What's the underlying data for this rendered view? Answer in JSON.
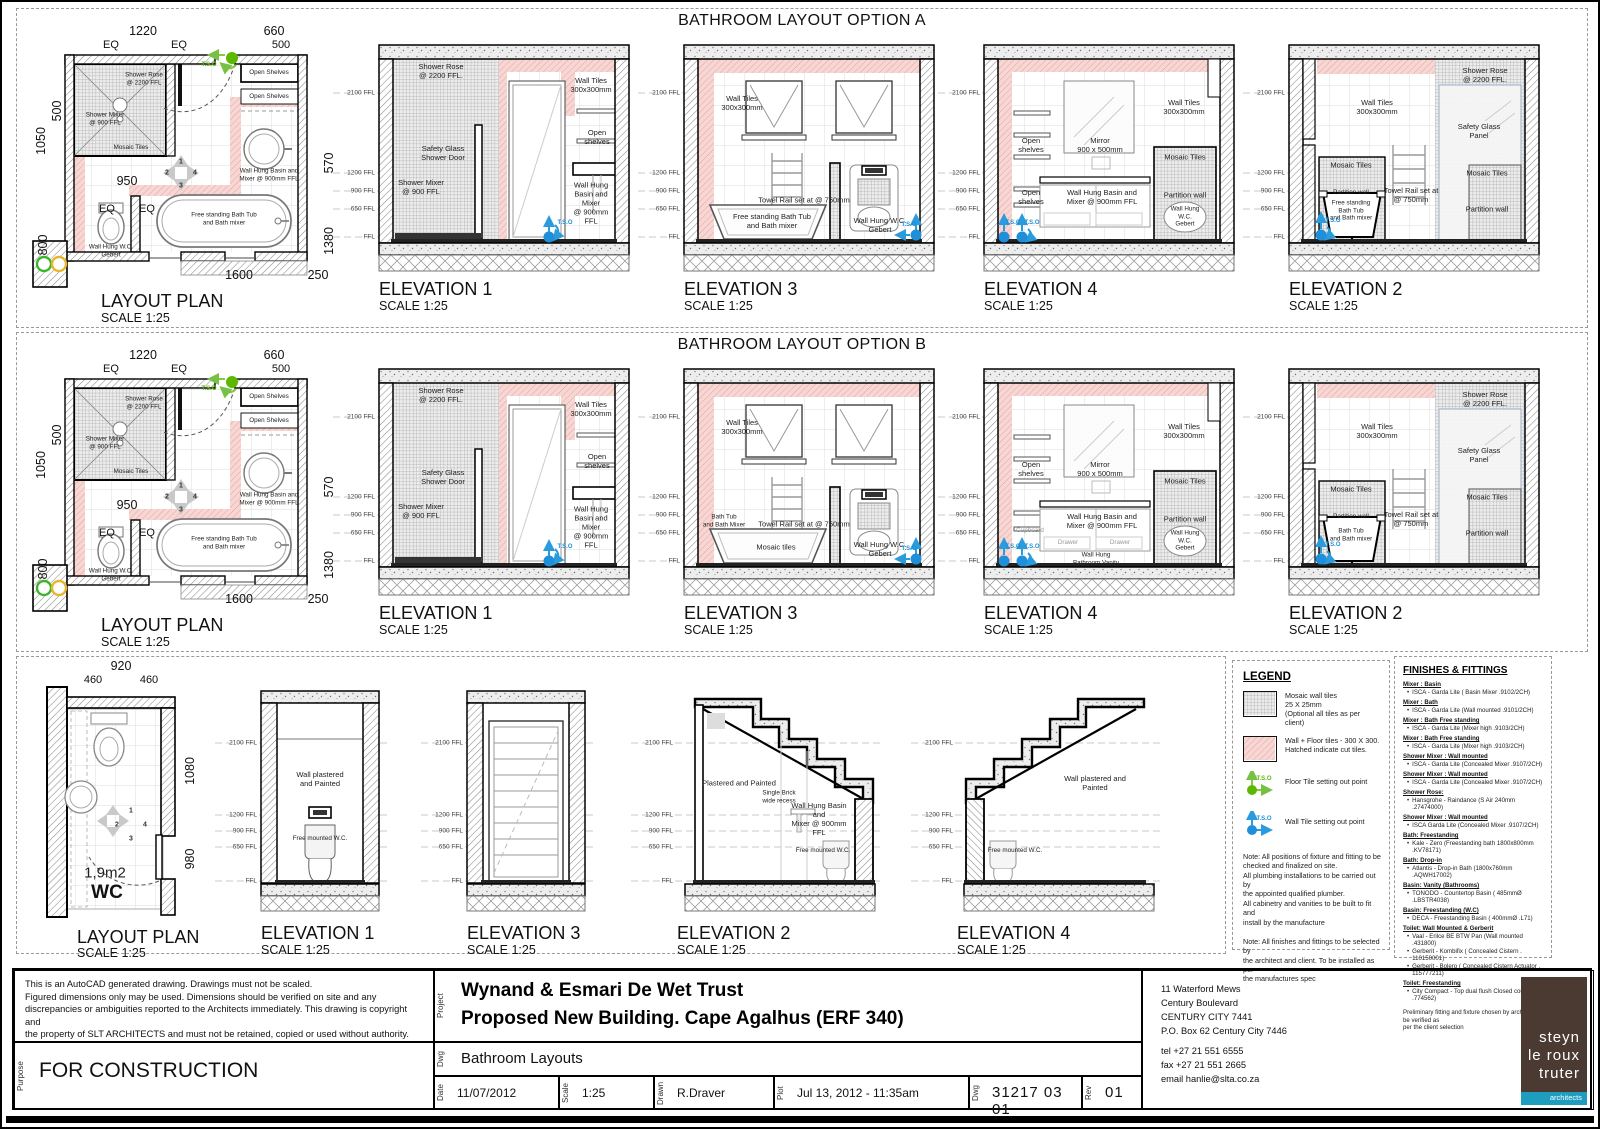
{
  "optionA": {
    "title": "BATHROOM LAYOUT OPTION A",
    "levels": [
      "2100 FFL",
      "1200 FFL",
      "900 FFL",
      "650 FFL",
      "FFL"
    ],
    "plan": {
      "caption": "LAYOUT PLAN",
      "scale": "SCALE 1:25",
      "dim_top": "1220",
      "dim_eq1": "EQ",
      "dim_eq2": "EQ",
      "dim_660": "660",
      "dim_500t": "500",
      "dim_1050": "1050",
      "dim_500l": "500",
      "dim_950": "950",
      "dim_eq3": "EQ",
      "dim_eq4": "EQ",
      "dim_800": "800",
      "dim_570": "570",
      "dim_1380": "1380",
      "dim_1600": "1600",
      "dim_250": "250",
      "lbl_shower_rose": "Shower Rose\n@ 2200 FFL",
      "lbl_shower_mixer": "Shower Mixer\n@ 900 FFL",
      "lbl_mosaic": "Mosaic Tiles",
      "lbl_shelves1": "Open Shelves",
      "lbl_shelves2": "Open Shelves",
      "lbl_basin": "Wall Hung Basin and\nMixer @ 900mm FFL",
      "lbl_bath": "Free standing Bath Tub\nand Bath mixer",
      "lbl_wc": "Wall Hung W.C.\nGebert",
      "tso": "T.S.O",
      "compass": [
        "1",
        "2",
        "3",
        "4"
      ]
    },
    "elev1": {
      "caption": "ELEVATION 1",
      "scale": "SCALE 1:25",
      "rose": "Shower Rose\n@ 2200 FFL.",
      "tiles": "Wall Tiles\n300x300mm",
      "shelves": "Open\nshelves",
      "door": "Safety Glass\nShower Door",
      "mixer": "Shower Mixer\n@ 900 FFL",
      "basin": "Wall Hung\nBasin and Mixer\n@ 900mm FFL",
      "tso": "T.S.O"
    },
    "elev3": {
      "caption": "ELEVATION 3",
      "scale": "SCALE 1:25",
      "tiles": "Wall Tiles\n300x300mm",
      "towel": "Towel Rail set at @ 750mm",
      "bath": "Free standing Bath Tub\nand Bath mixer",
      "wc": "Wall Hung W.C.\nGebert",
      "tso": "T.S.O"
    },
    "elev4": {
      "caption": "ELEVATION 4",
      "scale": "SCALE 1:25",
      "tiles": "Wall Tiles\n300x300mm",
      "shelves_top": "Open\nshelves",
      "mirror": "Mirror\n900 x 500mm",
      "mosaic": "Mosaic Tiles",
      "shelves_bot": "Open\nshelves",
      "basin": "Wall Hung Basin and\nMixer @ 900mm FFL",
      "partition": "Partition wall",
      "wc": "Wall Hung\nW.C.\nGebert",
      "tso1": "T.S.O",
      "tso2": "T.S.O"
    },
    "elev2": {
      "caption": "ELEVATION 2",
      "scale": "SCALE 1:25",
      "rose": "Shower Rose\n@ 2200 FFL.",
      "tiles": "Wall Tiles\n300x300mm",
      "glass": "Safety Glass\nPanel",
      "mosaic_l": "Mosaic Tiles",
      "mosaic_r": "Mosaic Tiles",
      "towel": "Towel Rail set at\n@ 750mm",
      "partition_l": "Partition wall",
      "partition_r": "Partition wall",
      "bath": "Free standing\nBath Tub\nand Bath mixer",
      "tso": "T.S.O"
    }
  },
  "optionB": {
    "title": "BATHROOM LAYOUT OPTION B",
    "levels": [
      "2100 FFL",
      "1200 FFL",
      "900 FFL",
      "650 FFL",
      "FFL"
    ],
    "plan": {
      "caption": "LAYOUT PLAN",
      "scale": "SCALE 1:25",
      "dim_top": "1220",
      "dim_eq1": "EQ",
      "dim_eq2": "EQ",
      "dim_660": "660",
      "dim_500t": "500",
      "dim_1050": "1050",
      "dim_500l": "500",
      "dim_950": "950",
      "dim_eq3": "EQ",
      "dim_eq4": "EQ",
      "dim_800": "800",
      "dim_570": "570",
      "dim_1380": "1380",
      "dim_1600": "1600",
      "dim_250": "250",
      "lbl_shower_rose": "Shower Rose\n@ 2200 FFL",
      "lbl_shower_mixer": "Shower Mixer\n@ 900 FFL",
      "lbl_mosaic": "Mosaic Tiles",
      "lbl_shelves1": "Open Shelves",
      "lbl_shelves2": "Open Shelves",
      "lbl_basin": "Wall Hung Basin and\nMixer @ 900mm FFL",
      "lbl_bath": "Free standing Bath Tub\nand Bath mixer",
      "lbl_wc": "Wall Hung W.C.\nGebert",
      "tso": "T.S.O",
      "compass": [
        "1",
        "2",
        "3",
        "4"
      ]
    },
    "elev1": {
      "caption": "ELEVATION 1",
      "scale": "SCALE 1:25",
      "rose": "Shower Rose\n@ 2200 FFL.",
      "tiles": "Wall Tiles\n300x300mm",
      "shelves": "Open\nshelves",
      "door": "Safety Glass\nShower Door",
      "mixer": "Shower Mixer\n@ 900 FFL",
      "basin": "Wall Hung\nBasin and Mixer\n@ 900mm FFL",
      "tso": "T.S.O"
    },
    "elev3": {
      "caption": "ELEVATION 3",
      "scale": "SCALE 1:25",
      "tiles": "Wall Tiles\n300x300mm",
      "towel": "Towel Rail set at @ 750mm",
      "bath_small": "Bath Tub\nand Bath Mixer",
      "mosaic_front": "Mosaic tiles",
      "wc": "Wall Hung W.C.\nGebert",
      "tso": "T.S.O"
    },
    "elev4": {
      "caption": "ELEVATION 4",
      "scale": "SCALE 1:25",
      "tiles": "Wall Tiles\n300x300mm",
      "shelves_top": "Open\nshelves",
      "mirror": "Mirror\n900 x 500mm",
      "mosaic": "Mosaic Tiles",
      "cupboard": "Cupboard",
      "basin": "Wall Hung Basin and\nMixer @ 900mm FFL",
      "partition": "Partition wall",
      "wc": "Wall Hung\nW.C.\nGebert",
      "drawer1": "Drawer",
      "drawer2": "Drawer",
      "vanity": "Wall Hung\nBathroom Vanity",
      "tso1": "T.S.O",
      "tso2": "T.S.O"
    },
    "elev2": {
      "caption": "ELEVATION 2",
      "scale": "SCALE 1:25",
      "rose": "Shower Rose\n@ 2200 FFL.",
      "tiles": "Wall Tiles\n300x300mm",
      "glass": "Safety Glass\nPanel",
      "mosaic_l": "Mosaic Tiles",
      "mosaic_r": "Mosaic Tiles",
      "towel": "Towel Rail set at\n@ 750mm",
      "partition_l": "Partition wall",
      "partition_r": "Partition wall",
      "bath": "Bath Tub\nand Bath mixer",
      "tso": "T.S.O"
    }
  },
  "wc": {
    "levels": [
      "2100 FFL",
      "1200 FFL",
      "900 FFL",
      "650 FFL",
      "FFL"
    ],
    "plan": {
      "caption": "LAYOUT PLAN",
      "scale": "SCALE 1:25",
      "dim_920": "920",
      "dim_460a": "460",
      "dim_460b": "460",
      "dim_1080": "1080",
      "dim_980": "980",
      "area": "1,9m2",
      "name": "WC",
      "compass": [
        "1",
        "2",
        "3",
        "4"
      ]
    },
    "elev1": {
      "caption": "ELEVATION 1",
      "scale": "SCALE 1:25",
      "wall": "Wall plastered and Painted",
      "wc": "Free mounted W.C."
    },
    "elev3": {
      "caption": "ELEVATION 3",
      "scale": "SCALE 1:25"
    },
    "elev2": {
      "caption": "ELEVATION 2",
      "scale": "SCALE 1:25",
      "wall": "Plastered and Painted",
      "recess": "Single Brick\nwide recess",
      "basin": "Wall Hung Basin and\nMixer @ 900mm FFL",
      "wc": "Free mounted W.C."
    },
    "elev4": {
      "caption": "ELEVATION 4",
      "scale": "SCALE 1:25",
      "wall": "Wall plastered and Painted",
      "wc": "Free mounted W.C."
    }
  },
  "legend": {
    "title": "LEGEND",
    "item1": "Mosaic wall tiles\n25 X 25mm\n(Optional all tiles as per client)",
    "item2": "Wall  + Floor tiles - 300 X 300.\nHatched indicate cut tiles.",
    "item3": "Floor Tile setting out point",
    "item4": "Wall Tile setting out point",
    "tso_g": "T.S.O",
    "tso_b": "T.S.O",
    "note1": "Note: All positions of fixture and fitting to be\nchecked and finalized on site.\nAll plumbing installations to be carried out by\nthe appointed qualified plumber.\nAll cabinetry and vanities to be built to fit and\ninstall by the manufacture",
    "note2": "Note: All finishes and fittings to be selected by\nthe architect and client. To be installed as per\nthe manufactures spec"
  },
  "finishes": {
    "title": "FINISHES & FITTINGS",
    "items": [
      {
        "h": "Mixer : Basin",
        "b": [
          "ISCA - Garda Lite ( Basin Mixer .9102/2CH)"
        ]
      },
      {
        "h": "Mixer : Bath",
        "b": [
          "ISCA - Garda Lite (Wall mounted  .9101/2CH)"
        ]
      },
      {
        "h": "Mixer : Bath Free standing",
        "b": [
          "ISCA - Garda Lite (Mixer high  .9103/2CH)"
        ]
      },
      {
        "h": "Mixer : Bath Free standing",
        "b": [
          "ISCA - Garda Lite (Mixer high  .9103/2CH)"
        ]
      },
      {
        "h": "Shower Mixer : Wall mounted",
        "b": [
          "ISCA - Garda Lite (Concealed Mixer  .9107/2CH)"
        ]
      },
      {
        "h": "Shower Mixer : Wall mounted",
        "b": [
          "ISCA - Garda Lite (Concealed Mixer  .9107/2CH)"
        ]
      },
      {
        "h": "Shower Rose:",
        "b": [
          "Hansgrohe - Raindance (S Air 240mm .27474000)"
        ]
      },
      {
        "h": "Shower Mixer : Wall mounted",
        "b": [
          "ISCA Garda Lite (Concealed Mixer  .9107/2CH)"
        ]
      },
      {
        "h": "Bath: Freestanding",
        "b": [
          "Kale - Zero (Freestanding bath 1800x800mm .KV78171)"
        ]
      },
      {
        "h": "Bath: Drop-in",
        "b": [
          "Atlantis - Drop-in Bath (1800x760mm .AQWH17002)"
        ]
      },
      {
        "h": "Basin: Vanity (Bathrooms)",
        "b": [
          "TONODO - Countertop Basin ( 485mmØ .LBSTR4038)"
        ]
      },
      {
        "h": "Basin: Freestanding (W.C)",
        "b": [
          "DECA - Freestanding Basin ( 400mmØ .L71)"
        ]
      },
      {
        "h": "Toilet: Wall Mounted & Gerberit",
        "b": [
          "Vaal - Erilce BE BTW Pan (Wall mounted .431800)",
          "Gerberit - Kombifix ( Concealed Cistern . 110150001)",
          "Gerberit - Bolero ( Concealed Cistern Actuator . 115777211)"
        ]
      },
      {
        "h": "Toilet: Freestanding",
        "b": [
          "City Compact - Top dual flush Closed couple suit .774562)"
        ]
      }
    ],
    "footer": "Preliminary fitting and fixture chosen by architect  to be verified as\nper the  client selection"
  },
  "titleblock": {
    "disclaimer": "This is an AutoCAD generated drawing.    Drawings must not be scaled.\nFigured dimensions only may be used. Dimensions should be verified on site and any\ndiscrepancies or  ambiguities reported to the Architects immediately. This drawing is copyright and\nthe property of SLT ARCHITECTS  and must not be retained, copied or used without authority.",
    "purpose_label": "Purpose",
    "purpose": "FOR CONSTRUCTION",
    "project_label": "Project",
    "project1": "Wynand & Esmari De Wet Trust",
    "project2": "Proposed New Building. Cape Agalhus (ERF 340)",
    "dwg_label": "Dwg",
    "dwg_title": "Bathroom Layouts",
    "date_label": "Date",
    "date": "11/07/2012",
    "scale_label": "Scale",
    "scale": "1:25",
    "drawn_label": "Drawn",
    "drawn": "R.Draver",
    "plot_label": "Plot",
    "plot": "Jul 13,  2012 - 11:35am",
    "dwgno_label": "Dwg",
    "dwgno": "31217  03    01",
    "rev_label": "Rev",
    "rev": "01",
    "address": "11 Waterford Mews\nCentury Boulevard\nCENTURY CITY 7441\nP.O. Box 62 Century City 7446",
    "contact": "tel  +27 21 551 6555\nfax +27 21 551 2665\nemail    hanlie@slta.co.za",
    "logo1": "steyn",
    "logo2": "le roux",
    "logo3": "truter",
    "logo4": "architects"
  }
}
